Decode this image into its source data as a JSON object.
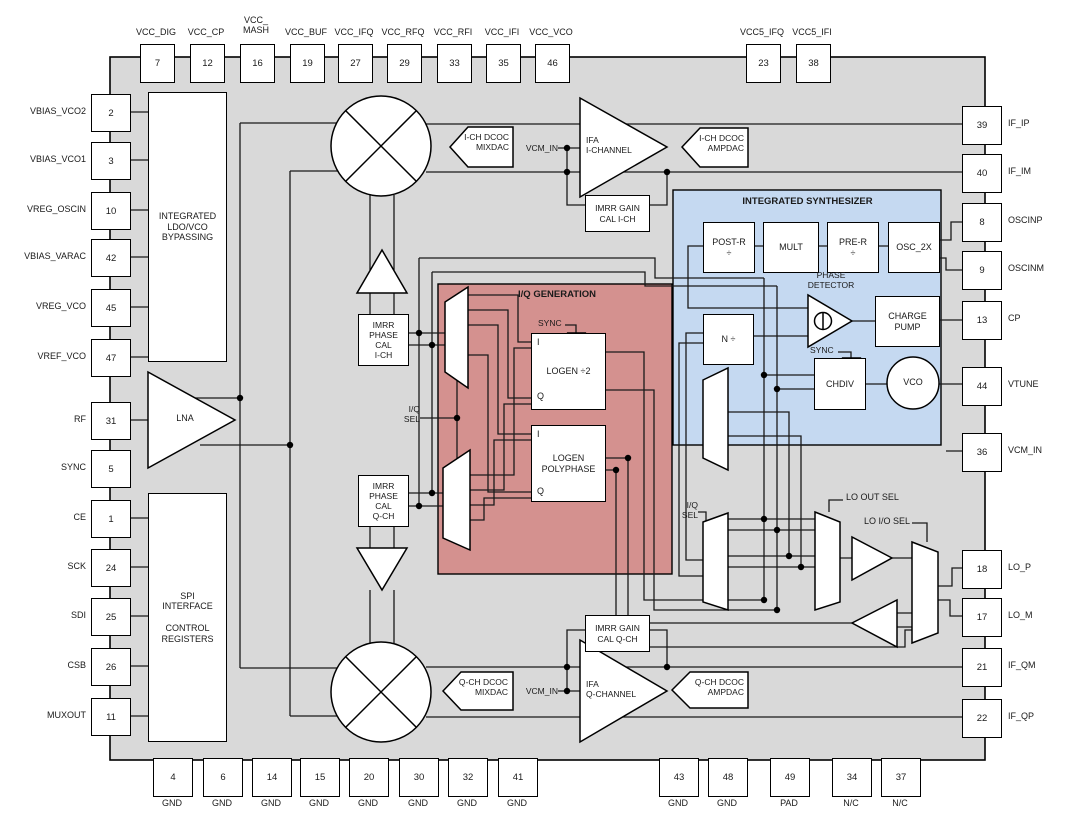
{
  "colors": {
    "chip_bg": "#D9D9D9",
    "iq_gen_bg": "#D4918F",
    "synth_bg": "#C5D9F1",
    "wire": "#1a1a1a"
  },
  "pins": {
    "top": [
      {
        "num": "7",
        "label": "VCC_DIG"
      },
      {
        "num": "12",
        "label": "VCC_CP"
      },
      {
        "num": "16",
        "label": "VCC_\nMASH"
      },
      {
        "num": "19",
        "label": "VCC_BUF"
      },
      {
        "num": "27",
        "label": "VCC_IFQ"
      },
      {
        "num": "29",
        "label": "VCC_RFQ"
      },
      {
        "num": "33",
        "label": "VCC_RFI"
      },
      {
        "num": "35",
        "label": "VCC_IFI"
      },
      {
        "num": "46",
        "label": "VCC_VCO"
      },
      {
        "num": "23",
        "label": "VCC5_IFQ"
      },
      {
        "num": "38",
        "label": "VCC5_IFI"
      }
    ],
    "left": [
      {
        "num": "2",
        "label": "VBIAS_VCO2"
      },
      {
        "num": "3",
        "label": "VBIAS_VCO1"
      },
      {
        "num": "10",
        "label": "VREG_OSCIN"
      },
      {
        "num": "42",
        "label": "VBIAS_VARAC"
      },
      {
        "num": "45",
        "label": "VREG_VCO"
      },
      {
        "num": "47",
        "label": "VREF_VCO"
      },
      {
        "num": "31",
        "label": "RF"
      },
      {
        "num": "5",
        "label": "SYNC"
      },
      {
        "num": "1",
        "label": "CE"
      },
      {
        "num": "24",
        "label": "SCK"
      },
      {
        "num": "25",
        "label": "SDI"
      },
      {
        "num": "26",
        "label": "CSB"
      },
      {
        "num": "11",
        "label": "MUXOUT"
      }
    ],
    "right": [
      {
        "num": "39",
        "label": "IF_IP"
      },
      {
        "num": "40",
        "label": "IF_IM"
      },
      {
        "num": "8",
        "label": "OSCINP"
      },
      {
        "num": "9",
        "label": "OSCINM"
      },
      {
        "num": "13",
        "label": "CP"
      },
      {
        "num": "44",
        "label": "VTUNE"
      },
      {
        "num": "36",
        "label": "VCM_IN"
      },
      {
        "num": "18",
        "label": "LO_P"
      },
      {
        "num": "17",
        "label": "LO_M"
      },
      {
        "num": "21",
        "label": "IF_QM"
      },
      {
        "num": "22",
        "label": "IF_QP"
      }
    ],
    "bottom": [
      {
        "num": "4",
        "label": "GND"
      },
      {
        "num": "6",
        "label": "GND"
      },
      {
        "num": "14",
        "label": "GND"
      },
      {
        "num": "15",
        "label": "GND"
      },
      {
        "num": "20",
        "label": "GND"
      },
      {
        "num": "30",
        "label": "GND"
      },
      {
        "num": "32",
        "label": "GND"
      },
      {
        "num": "41",
        "label": "GND"
      },
      {
        "num": "43",
        "label": "GND"
      },
      {
        "num": "48",
        "label": "GND"
      },
      {
        "num": "49",
        "label": "PAD"
      },
      {
        "num": "34",
        "label": "N/C"
      },
      {
        "num": "37",
        "label": "N/C"
      }
    ]
  },
  "blocks": {
    "ldo": "INTEGRATED\nLDO/VCO\nBYPASSING",
    "lna": "LNA",
    "spi": "SPI\nINTERFACE\n\nCONTROL\nREGISTERS",
    "imrr_phase_i": "IMRR\nPHASE\nCAL\nI-CH",
    "imrr_phase_q": "IMRR\nPHASE\nCAL\nQ-CH",
    "iq_gen_title": "I/Q GENERATION",
    "logen_div2": "LOGEN ÷2",
    "logen_poly": "LOGEN\nPOLYPHASE",
    "synth_title": "INTEGRATED SYNTHESIZER",
    "post_r": "POST-R\n÷",
    "mult": "MULT",
    "pre_r": "PRE-R\n÷",
    "osc_2x": "OSC_2X",
    "phase_detector": "PHASE\nDETECTOR",
    "charge_pump": "CHARGE\nPUMP",
    "n_div": "N ÷",
    "chdiv": "CHDIV",
    "vco": "VCO",
    "mixdac_i": "I-CH DCOC\nMIXDAC",
    "ampdac_i": "I-CH DCOC\nAMPDAC",
    "ifa_i": "IFA\nI-CHANNEL",
    "imrr_gain_i": "IMRR GAIN\nCAL I-CH",
    "mixdac_q": "Q-CH DCOC\nMIXDAC",
    "ampdac_q": "Q-CH DCOC\nAMPDAC",
    "ifa_q": "IFA\nQ-CHANNEL",
    "imrr_gain_q": "IMRR GAIN\nCAL Q-CH"
  },
  "ports": {
    "i": "I",
    "q": "Q"
  },
  "labels": {
    "vcm_in": "VCM_IN",
    "sync": "SYNC",
    "iq_sel": "I/Q\nSEL",
    "lo_out_sel": "LO OUT SEL",
    "lo_io_sel": "LO I/O SEL"
  }
}
